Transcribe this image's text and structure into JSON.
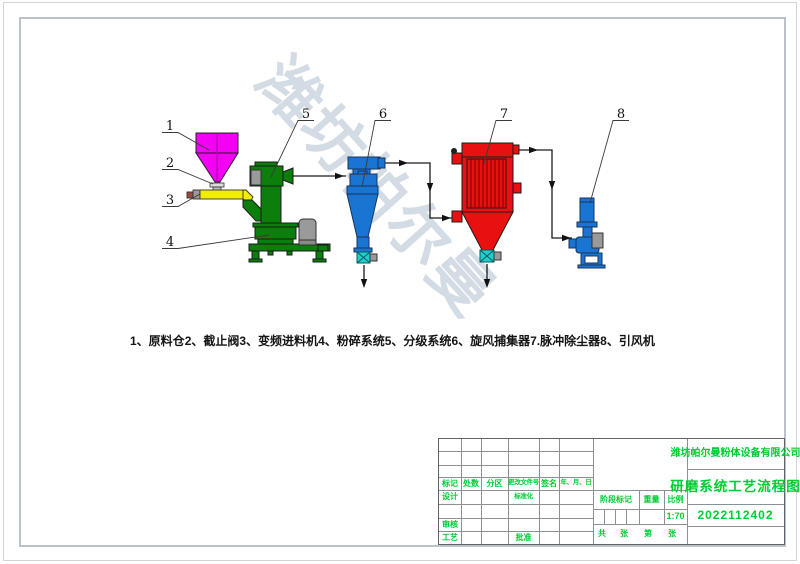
{
  "drawing": {
    "watermark": "潍坊帕尔曼",
    "callouts": [
      "1",
      "2",
      "3",
      "4",
      "5",
      "6",
      "7",
      "8"
    ],
    "legend_items": [
      "1、原料仓",
      "2、截止阀",
      "3、变频进料机",
      "4、粉碎系统",
      "5、分级系统",
      "6、旋风捕集器",
      "7.脉冲除尘器",
      "8、引风机"
    ]
  },
  "title_block": {
    "company": "潍坊帕尔曼粉体设备有限公司",
    "drawing_title": "研磨系统工艺流程图",
    "drawing_number": "2022112402",
    "scale_value": "1:70",
    "labels": {
      "mark": "标记",
      "count": "处数",
      "zone": "分区",
      "change_no": "更改文件号",
      "sign": "签名",
      "date": "年、月、日",
      "design": "设计",
      "standardize": "标准化",
      "check": "审核",
      "process": "工艺",
      "approve": "批准",
      "stage_mark": "阶段标记",
      "weight": "重量",
      "scale": "比例",
      "total": "共",
      "sheet1": "张",
      "page": "第",
      "sheet2": "张"
    }
  },
  "colors": {
    "hopper": "#f400f4",
    "hopper-line": "#b000b0",
    "feeder": "#f2ee00",
    "mill": "#0b7e0b",
    "cyclone": "#1a74d2",
    "collector": "#e81010",
    "collector-bag-line": "#7a0000",
    "fan": "#1a74d2",
    "rotary-valve": "#1ecfcf",
    "motor": "#9a9a9a",
    "annotation-green": "#00cc33",
    "line": "#1a1a1a",
    "watermark": "#ccd6e0"
  }
}
